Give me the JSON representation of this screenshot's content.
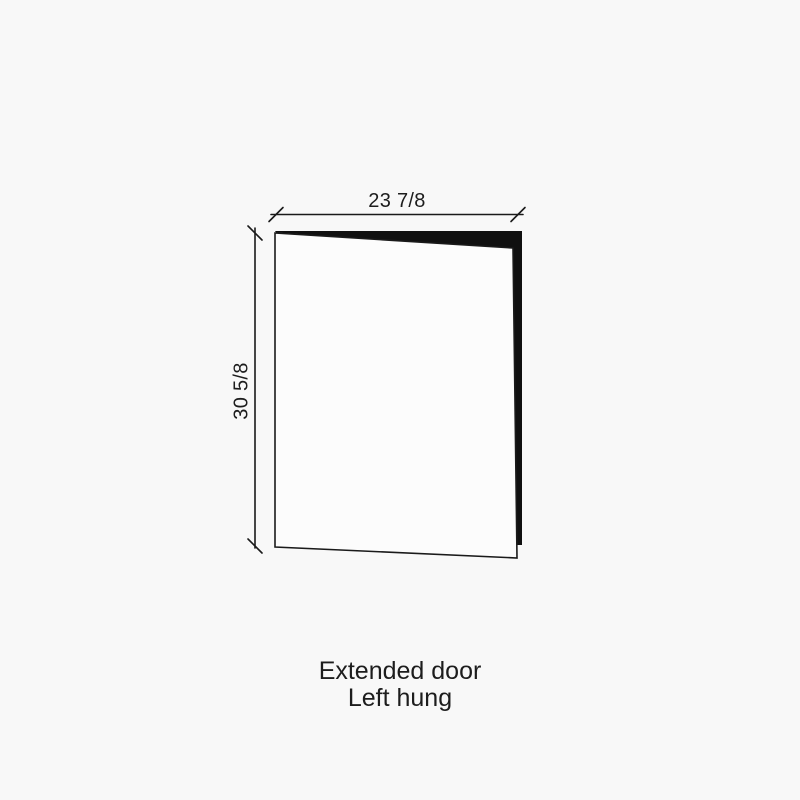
{
  "diagram": {
    "type": "cabinet-door-spec-drawing",
    "width_label": "23 7/8",
    "height_label": "30 5/8",
    "caption_line1": "Extended door",
    "caption_line2": "Left hung"
  },
  "colors": {
    "background": "#f8f8f8",
    "line": "#1a1a1a",
    "door_face": "#fcfcfc",
    "door_edge": "#101010",
    "text": "#1d1d1d"
  }
}
